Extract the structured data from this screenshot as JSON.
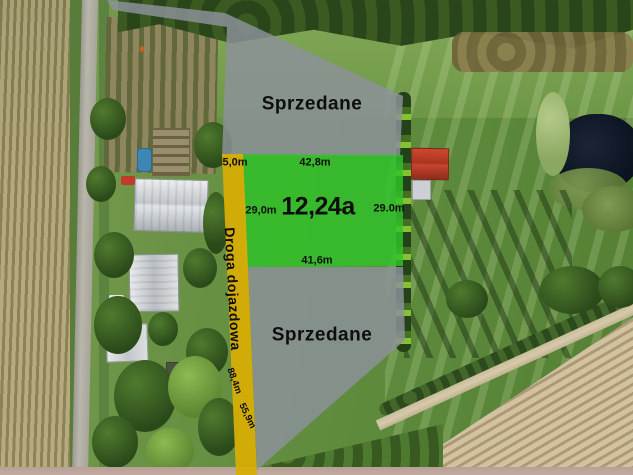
{
  "listing_overlay": {
    "available_plot": {
      "area_label": "12,24a",
      "width_top": "42,8m",
      "width_bottom": "41,6m",
      "depth_left": "29,0m",
      "depth_right": "29.0m",
      "fill_color": "#2fc32a"
    },
    "sold_plots": {
      "top_label": "Sprzedane",
      "bottom_label": "Sprzedane",
      "fill_color": "#8c9198"
    },
    "access_road": {
      "label": "Droga dojazdowa",
      "width_label": "5,0m",
      "length_label_upper": "88,4m",
      "length_label_lower": "55,9m",
      "fill_color": "#d7ae06"
    }
  }
}
